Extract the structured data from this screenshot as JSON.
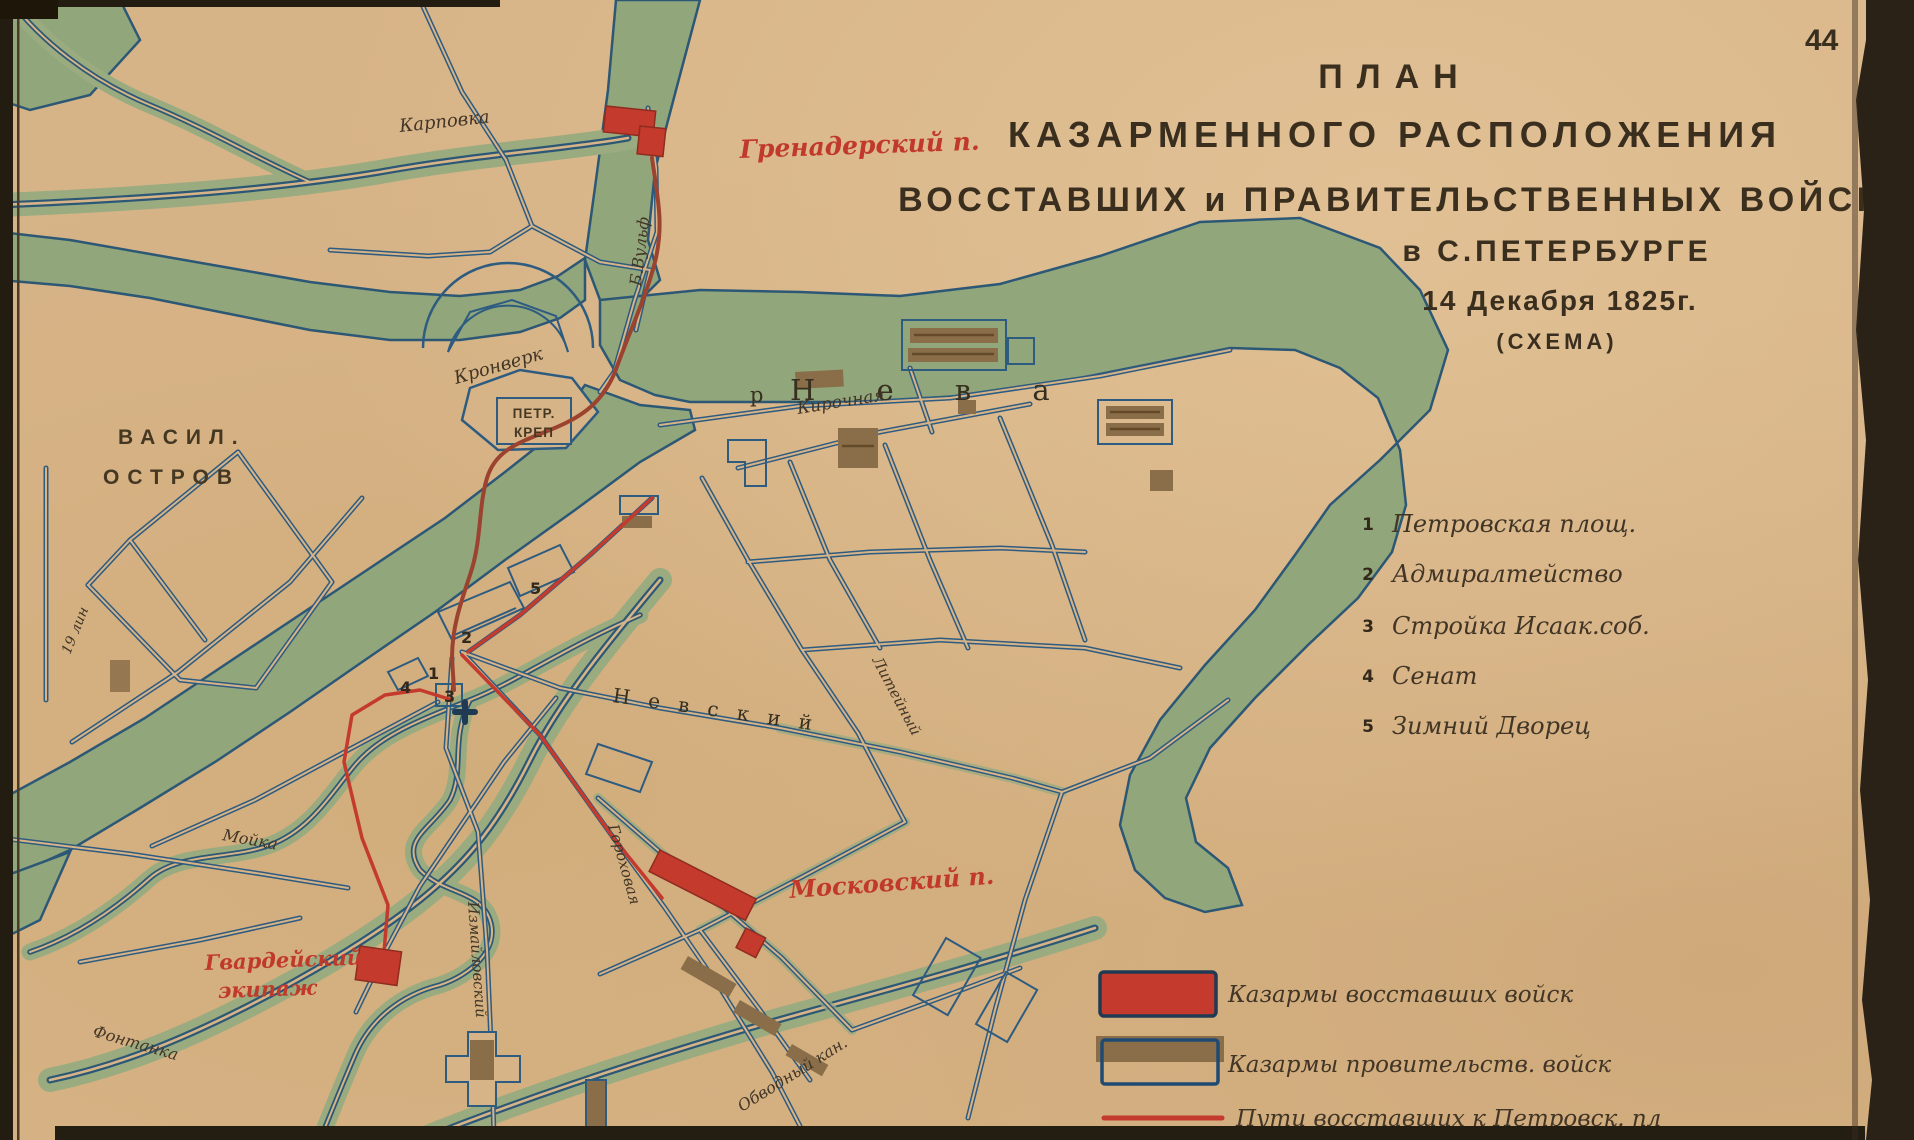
{
  "page": {
    "number": "44"
  },
  "title": {
    "line1": "ПЛАН",
    "line2": "КАЗАРМЕННОГО РАСПОЛОЖЕНИЯ",
    "line3": "ВОССТАВШИХ и ПРАВИТЕЛЬСТВЕННЫХ ВОЙСК.",
    "line4": "в С.ПЕТЕРБУРГЕ",
    "line5": "14 Декабря 1825г.",
    "line6": "(СХЕМА)"
  },
  "landmarks": {
    "items": [
      {
        "num": "1",
        "label": "Петровская площ."
      },
      {
        "num": "2",
        "label": "Адмиралтейство"
      },
      {
        "num": "3",
        "label": "Стройка Исаак.соб."
      },
      {
        "num": "4",
        "label": "Сенат"
      },
      {
        "num": "5",
        "label": "Зимний Дворец"
      }
    ]
  },
  "legend": {
    "rebel_barracks": "Казармы восставших войск",
    "government_barracks": "Казармы провительств. войск",
    "rebel_routes": "Пути восставших к Петровск. пл"
  },
  "map_labels": {
    "karpovka": "Карповка",
    "grenadersky": "Гренадерский п.",
    "b_vulf": "Б.Вульф",
    "kronverk": "Кронверк",
    "petr_krep_1": "ПЕТР.",
    "petr_krep_2": "КРЕП",
    "neva_prefix": "р",
    "neva": "Н е в а",
    "kirochnaya": "Кирочная",
    "vasil": "ВАСИЛ.",
    "ostrov": "ОСТРОВ",
    "line19": "19 лин",
    "nevsky": "Н е в с к и й",
    "liteyny": "Литейный",
    "gorokhovaya": "Гороховая",
    "izmailovsky": "Измайловский",
    "moika": "Мойка",
    "fontanka": "Фонтанка",
    "obvodny": "Обводный кан.",
    "moskovsky": "Московский п.",
    "gvardeisky_1": "Гвардейский",
    "gvardeisky_2": "экипаж"
  },
  "map_numbers": {
    "n1": "1",
    "n2": "2",
    "n3": "3",
    "n4": "4",
    "n5": "5"
  },
  "colors": {
    "paper": "#d7b488",
    "water_green": "#92a67c",
    "water_line": "#2c5876",
    "street_blue": "#2e5b80",
    "rebel_red": "#c43a2c",
    "route_dark_red": "#9c4330",
    "gov_brown": "#8a6e49",
    "ink": "#352a1c",
    "red_text": "#c0392a"
  }
}
